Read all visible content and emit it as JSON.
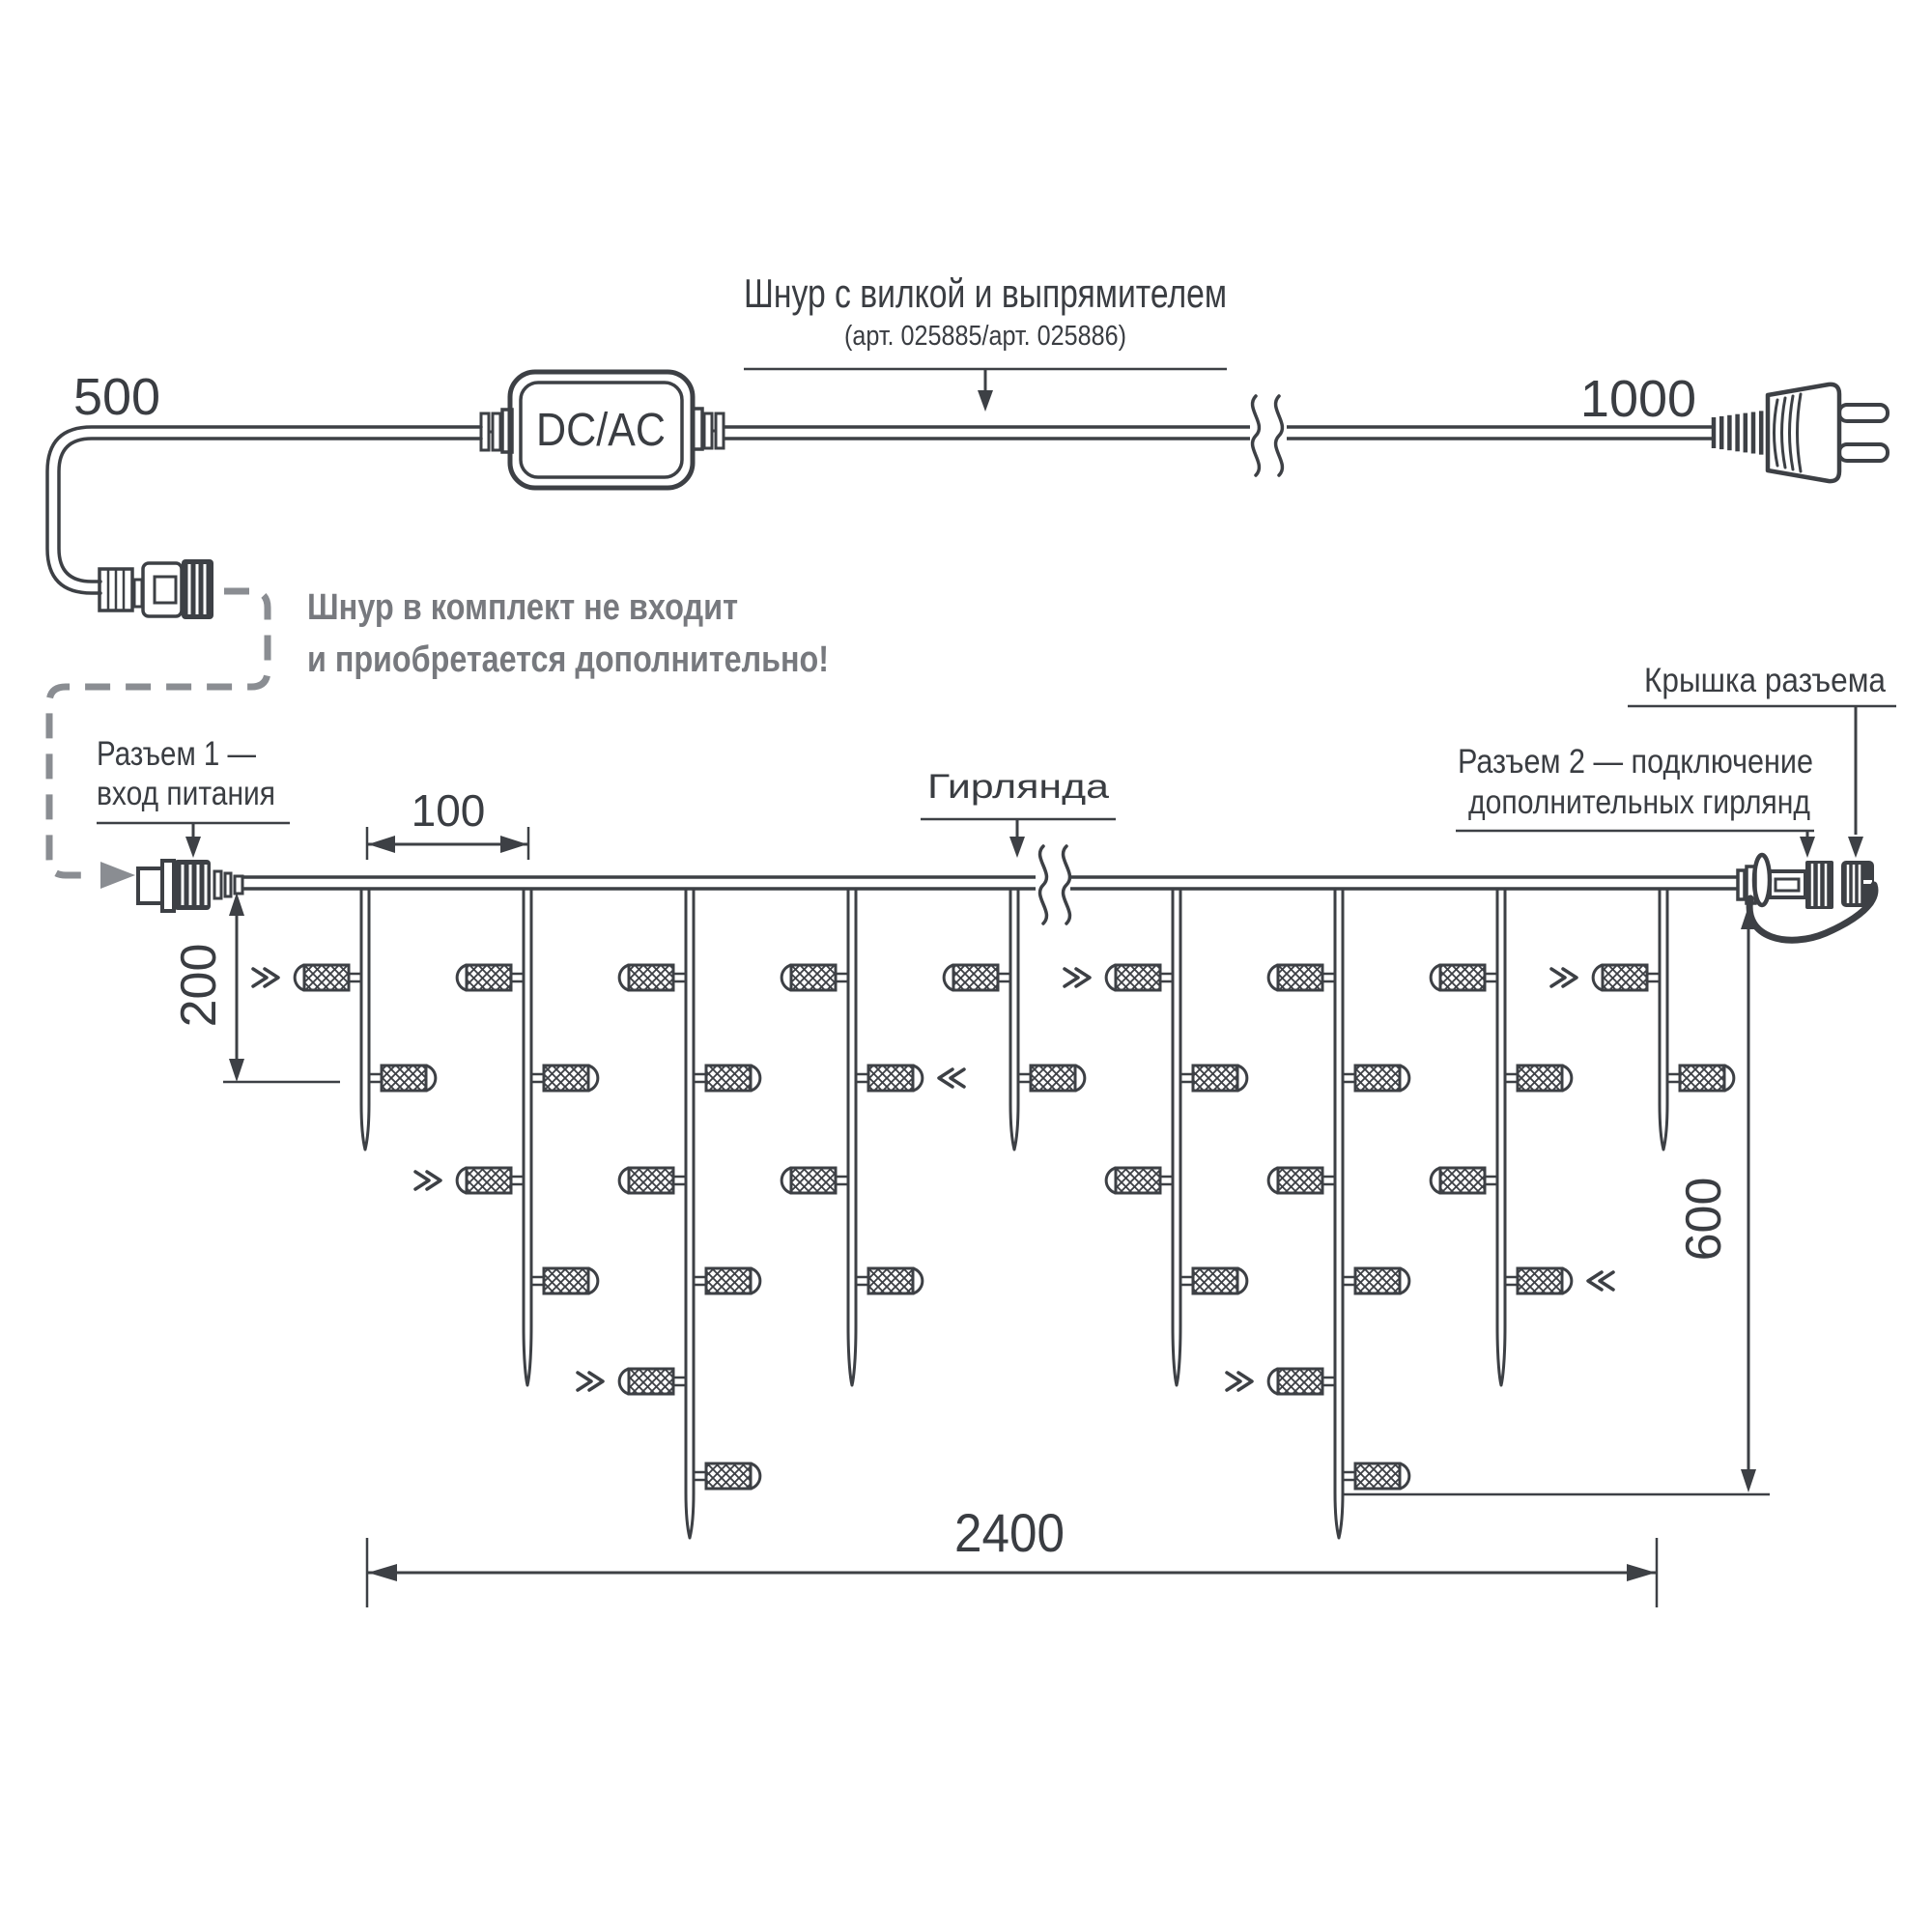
{
  "power_cord": {
    "label": "Шнур с вилкой и выпрямителем",
    "article": "(арт. 025885/арт. 025886)",
    "converter_label": "DC/AC",
    "left_length": "500",
    "right_length": "1000",
    "note_line1": "Шнур в комплект не входит",
    "note_line2": "и приобретается дополнительно!"
  },
  "garland": {
    "label": "Гирлянда",
    "connector1_label_line1": "Разъем 1 —",
    "connector1_label_line2": "вход питания",
    "connector2_label_line1": "Разъем 2 — подключение",
    "connector2_label_line2": "дополнительных гирлянд",
    "cap_label": "Крышка разъема",
    "dimensions": {
      "led_spacing": "100",
      "drop_offset": "200",
      "height": "600",
      "length": "2400"
    },
    "structure": {
      "drop_pattern": [
        "short",
        "medium",
        "long",
        "medium",
        "short",
        "medium",
        "long",
        "medium",
        "short"
      ],
      "leds_per_drop": {
        "short": 2,
        "medium": 4,
        "long": 6
      },
      "flash_marks": [
        [
          1,
          1
        ],
        [
          2,
          3
        ],
        [
          3,
          5
        ],
        [
          4,
          2
        ],
        [
          6,
          1
        ],
        [
          7,
          5
        ],
        [
          8,
          4
        ],
        [
          9,
          1
        ]
      ]
    }
  },
  "colors": {
    "line": "#3d4045",
    "gray": "#8a8d92",
    "gray_text": "#77797e",
    "background": "#ffffff"
  }
}
